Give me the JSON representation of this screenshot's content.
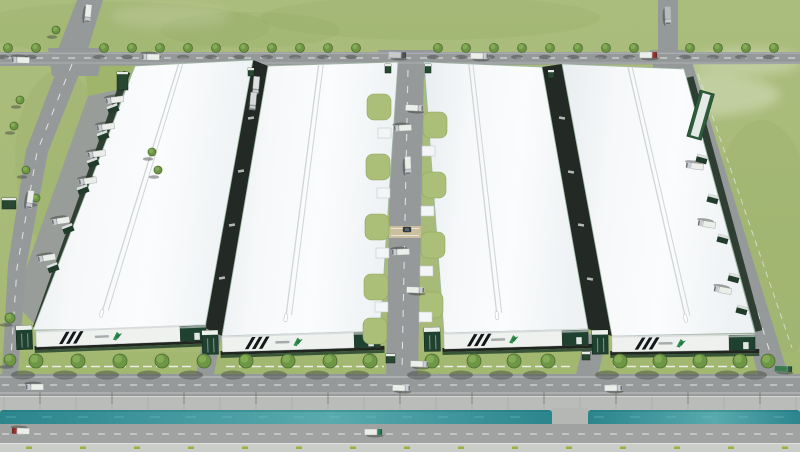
{
  "meta": {
    "description": "Aerial 3D rendering of an industrial logistics park: four white-roofed warehouses with dark-green and striped facades, a central service road with landscaped islands, tree-lined perimeter roads with trucks, loading docks, a canal with embankment along the front highway, and green fields around.",
    "canvas": {
      "w": 800,
      "h": 452
    }
  },
  "palette": {
    "grass": "#a9bc7a",
    "grass_dark": "#93a862",
    "lawn": "#a2b76f",
    "lawn_wedge": "#9fb56b",
    "road": "#96999a",
    "apron": "#999d99",
    "dash": "#f2f3f1",
    "edge_line": "#d9dad8",
    "roof_edge": "#9db8a5",
    "ridge": "#cfd5d8",
    "facade": "#eff1ef",
    "facade_top": "#d8dcdd",
    "green_dark": "#1f4130",
    "stripe": "#14181a",
    "logo_green": "#2e9150",
    "logo_green_dark": "#257a43",
    "alley": "#232924",
    "dock_band": "#2a3a2d",
    "canopy": "#223c2b",
    "canopy_top": "#dce1df",
    "canal_a": "#2b858d",
    "canal_b": "#58aaad",
    "embankment": "#b9bcb8",
    "seam": "#a3a6a3",
    "sidewalk": "#cbcdc9",
    "sidewalk_dash": "#9fae3e",
    "bridge": "#b4b7b4",
    "tree": "#6d9745",
    "tree_rim": "#4c6c31",
    "tree_hi": "#87ad58",
    "shadow": "#3e433d",
    "truck_body": "#eceeea",
    "truck_cab": "#c9cdd2",
    "truck_red": "#a03028",
    "truck_green": "#2e7d52",
    "fence": "#eef0ec",
    "booth": "#294832",
    "pod": "#f3f5f6",
    "island": "#abbf78"
  },
  "scene": {
    "grass_patches": [
      [
        120,
        28,
        150,
        26
      ],
      [
        430,
        18,
        170,
        22
      ],
      [
        762,
        250,
        55,
        130
      ],
      [
        60,
        160,
        45,
        90
      ],
      [
        250,
        30,
        90,
        18
      ]
    ],
    "clouds": [
      [
        690,
        95,
        90,
        22,
        0.28
      ],
      [
        745,
        62,
        55,
        14,
        0.25
      ],
      [
        600,
        118,
        70,
        16,
        0.16
      ],
      [
        170,
        16,
        60,
        12,
        0.12
      ]
    ],
    "front_lawn": "0,352 800,352 800,374 0,374",
    "lawn_wedge": "84,64 135,66 126,88 88,96",
    "apron": "88,96 126,88 36,326 14,302",
    "roads": [
      {
        "name": "road-top",
        "pts": "0,52 800,52 800,64 0,66"
      },
      {
        "name": "road-stub-left",
        "pts": "77,0 103,0 87,52 57,52"
      },
      {
        "name": "road-stub-right",
        "pts": "658,0 678,0 678,52 658,52"
      },
      {
        "name": "junction-left",
        "pts": "48,48 104,48 98,76 52,76"
      },
      {
        "name": "junction-central",
        "pts": "378,50 436,50 430,78 384,78"
      },
      {
        "name": "junction-right",
        "pts": "650,50 686,50 686,72 654,72"
      },
      {
        "name": "road-left-1",
        "pts": "60,62 84,62 48,152 26,150"
      },
      {
        "name": "road-left-2",
        "pts": "26,150 48,152 26,268 8,264"
      },
      {
        "name": "road-left-3",
        "pts": "8,264 26,268 18,374 2,374"
      },
      {
        "name": "road-central",
        "pts": "392,66 424,66 418,374 386,374"
      },
      {
        "name": "road-right",
        "pts": "670,62 692,62 788,374 758,374"
      },
      {
        "name": "central-exit",
        "pts": "392,334 416,334 412,374 388,374"
      },
      {
        "name": "alley12-exit",
        "pts": "204,332 222,332 214,374 196,374"
      },
      {
        "name": "alley34-exit",
        "pts": "586,334 608,334 598,374 576,374"
      },
      {
        "name": "road-front",
        "pts": "0,374 800,374 800,396 0,396"
      }
    ],
    "dashes": [
      {
        "name": "top-centerline",
        "d": "M4,58 L796,58"
      },
      {
        "name": "left-centerline",
        "d": "M72,64 L37,152 L17,268 L10,372"
      },
      {
        "name": "central-centerline",
        "d": "M408,70 L402,370"
      },
      {
        "name": "right-centerline",
        "d": "M682,68 L776,372"
      },
      {
        "name": "front-centerline",
        "d": "M2,385 L798,385"
      },
      {
        "name": "highway-centerline",
        "d": "M2,434 L798,434"
      }
    ],
    "edge_lines": [
      {
        "d": "M0,53.2 L800,53.2",
        "o": 0.5
      },
      {
        "d": "M0,63 L800,63",
        "o": 0.5
      },
      {
        "d": "M0,377 L800,377",
        "o": 0.9
      },
      {
        "d": "M0,393 L800,393",
        "o": 0.9
      },
      {
        "d": "M0,427.5 L800,427.5",
        "o": 0.9
      },
      {
        "d": "M0,441 L800,441",
        "o": 0.9
      }
    ],
    "right_fence": "M698,74 L792,348",
    "embankment": {
      "y": 396,
      "h": 15,
      "seam_step": 36
    },
    "canal": {
      "segs": [
        [
          0,
          552
        ],
        [
          588,
          800
        ]
      ],
      "y": 410,
      "h": 16,
      "bridge": [
        552,
        408,
        36,
        20
      ]
    },
    "highway": {
      "y": 424,
      "h": 20
    },
    "sidewalk": {
      "y": 443,
      "h": 9,
      "dash_step": 54,
      "dash_start": 26
    },
    "poles": {
      "xs": [
        40,
        112,
        184,
        256,
        328,
        400,
        472,
        544,
        616,
        688,
        760
      ],
      "y1": 392,
      "y2": 404
    },
    "crosswalk": [
      389,
      226,
      32,
      12
    ],
    "car": [
      403,
      227
    ],
    "alleys": [
      {
        "pts": "253,60 268,66 222,336 205,328",
        "rot": -10,
        "ticks": [
          [
            251,
            118
          ],
          [
            241,
            171
          ],
          [
            232,
            225
          ],
          [
            222,
            278
          ]
        ]
      },
      {
        "pts": "542,67 562,64 612,336 588,329",
        "rot": 10,
        "ticks": [
          [
            562,
            118
          ],
          [
            571,
            172
          ],
          [
            581,
            225
          ],
          [
            590,
            279
          ]
        ]
      }
    ],
    "buildings": [
      {
        "name": "warehouse-1",
        "quad": [
          [
            135,
            66
          ],
          [
            253,
            60
          ],
          [
            205,
            328
          ],
          [
            33,
            330
          ]
        ],
        "ridge": [
          0.37,
          0.405
        ],
        "facade": {
          "x": 36,
          "y": 331,
          "w": 170,
          "angle": -2.2
        },
        "dock_band": [
          [
            127,
            72
          ],
          [
            36,
            328
          ]
        ]
      },
      {
        "name": "warehouse-2",
        "quad": [
          [
            268,
            66
          ],
          [
            398,
            62
          ],
          [
            380,
            331
          ],
          [
            222,
            336
          ]
        ],
        "ridge": [
          0.39,
          0.425
        ],
        "facade": {
          "x": 222,
          "y": 336,
          "w": 158,
          "angle": -1.8
        }
      },
      {
        "name": "warehouse-3",
        "quad": [
          [
            424,
            62
          ],
          [
            542,
            67
          ],
          [
            588,
            329
          ],
          [
            444,
            333
          ]
        ],
        "ridge": [
          0.38,
          0.415
        ],
        "facade": {
          "x": 444,
          "y": 333,
          "w": 144,
          "angle": -1.6
        }
      },
      {
        "name": "warehouse-4",
        "quad": [
          [
            562,
            64
          ],
          [
            684,
            69
          ],
          [
            755,
            333
          ],
          [
            612,
            336
          ]
        ],
        "ridge": [
          0.54,
          0.575
        ],
        "facade": {
          "x": 612,
          "y": 336,
          "w": 143,
          "angle": -0.8
        },
        "dock_band": [
          [
            690,
            77
          ],
          [
            759,
            331
          ]
        ]
      }
    ],
    "dock_canopies": [
      [
        120,
        106,
        -21
      ],
      [
        110,
        133,
        -21
      ],
      [
        100,
        160,
        -21
      ],
      [
        90,
        187,
        -21
      ],
      [
        75,
        226,
        -21
      ],
      [
        60,
        265,
        -21
      ],
      [
        709,
        161,
        15
      ],
      [
        720,
        201,
        15
      ],
      [
        730,
        241,
        15
      ],
      [
        741,
        280,
        15
      ],
      [
        749,
        312,
        15
      ]
    ],
    "islands": [
      [
        367,
        94
      ],
      [
        366,
        154
      ],
      [
        365,
        214
      ],
      [
        364,
        274
      ],
      [
        363,
        318
      ],
      [
        423,
        112
      ],
      [
        422,
        172
      ],
      [
        421,
        232
      ],
      [
        419,
        292
      ]
    ],
    "pods": [
      [
        378,
        128
      ],
      [
        377,
        188
      ],
      [
        376,
        248
      ],
      [
        375,
        302
      ],
      [
        422,
        146
      ],
      [
        421,
        206
      ],
      [
        420,
        266
      ],
      [
        419,
        312
      ]
    ],
    "booths": [
      [
        385,
        64,
        6,
        9
      ],
      [
        425,
        64,
        6,
        9
      ],
      [
        248,
        68,
        6,
        8
      ],
      [
        548,
        70,
        6,
        8
      ],
      [
        582,
        352,
        8,
        8
      ],
      [
        386,
        354,
        9,
        9
      ],
      [
        2,
        198,
        14,
        11
      ],
      [
        117,
        72,
        11,
        18
      ]
    ],
    "green_structure": {
      "x": 700,
      "y": 90,
      "w": 15,
      "h": 48,
      "angle": 16
    },
    "fence_segments": [
      [
        26,
        192
      ],
      [
        226,
        384
      ],
      [
        418,
        570
      ],
      [
        614,
        748
      ]
    ],
    "trees": {
      "top": {
        "y": 48,
        "r": 4.5,
        "xs": [
          8,
          36,
          104,
          132,
          160,
          188,
          216,
          244,
          272,
          300,
          328,
          356,
          438,
          466,
          494,
          522,
          550,
          578,
          606,
          634,
          690,
          718,
          746,
          774
        ]
      },
      "front": {
        "y": 361,
        "r": 7,
        "xs": [
          36,
          78,
          120,
          162,
          204,
          246,
          288,
          330,
          370,
          432,
          474,
          514,
          548,
          620,
          660,
          700,
          740,
          768
        ]
      },
      "misc": [
        [
          56,
          30,
          4
        ],
        [
          20,
          100,
          4
        ],
        [
          14,
          126,
          4
        ],
        [
          26,
          170,
          4
        ],
        [
          36,
          198,
          4
        ],
        [
          10,
          318,
          5
        ],
        [
          10,
          360,
          6
        ],
        [
          152,
          152,
          4
        ],
        [
          158,
          170,
          4
        ]
      ]
    },
    "trucks": [
      {
        "x": 20,
        "y": 60,
        "a": 182
      },
      {
        "x": 150,
        "y": 57,
        "a": 181
      },
      {
        "x": 398,
        "y": 55,
        "a": 2,
        "body": "#c6cacc",
        "cab": "#53585b"
      },
      {
        "x": 480,
        "y": 56,
        "a": 1
      },
      {
        "x": 649,
        "y": 55,
        "a": 0,
        "cab": "#a03028"
      },
      {
        "x": 88,
        "y": 14,
        "a": 96
      },
      {
        "x": 668,
        "y": 16,
        "a": 88,
        "body": "#b8bcbe"
      },
      {
        "x": 256,
        "y": 86,
        "a": 95,
        "body": "#dfe2e3"
      },
      {
        "x": 253,
        "y": 102,
        "a": 95,
        "body": "#d6dadb"
      },
      {
        "x": 402,
        "y": 128,
        "a": 177
      },
      {
        "x": 415,
        "y": 108,
        "a": 3
      },
      {
        "x": 400,
        "y": 252,
        "a": 178
      },
      {
        "x": 416,
        "y": 290,
        "a": 2
      },
      {
        "x": 408,
        "y": 166,
        "a": 88
      },
      {
        "x": 420,
        "y": 364,
        "a": 2
      },
      {
        "x": 114,
        "y": 100,
        "a": 172
      },
      {
        "x": 105,
        "y": 127,
        "a": 172
      },
      {
        "x": 96,
        "y": 154,
        "a": 172
      },
      {
        "x": 87,
        "y": 181,
        "a": 172
      },
      {
        "x": 60,
        "y": 221,
        "a": 171
      },
      {
        "x": 46,
        "y": 258,
        "a": 171
      },
      {
        "x": 694,
        "y": 166,
        "a": 187
      },
      {
        "x": 706,
        "y": 224,
        "a": 189
      },
      {
        "x": 722,
        "y": 290,
        "a": 190
      },
      {
        "x": 30,
        "y": 200,
        "a": 98
      },
      {
        "x": 34,
        "y": 387,
        "a": 180
      },
      {
        "x": 402,
        "y": 388,
        "a": 2
      },
      {
        "x": 614,
        "y": 388,
        "a": 0
      },
      {
        "x": 784,
        "y": 369,
        "a": 2,
        "body": "#3a7a4b",
        "cab": "#2c5c39"
      },
      {
        "x": 20,
        "y": 431,
        "a": 182,
        "cab": "#a03028"
      },
      {
        "x": 374,
        "y": 432,
        "a": 0,
        "cab": "#2e7d52"
      }
    ]
  }
}
